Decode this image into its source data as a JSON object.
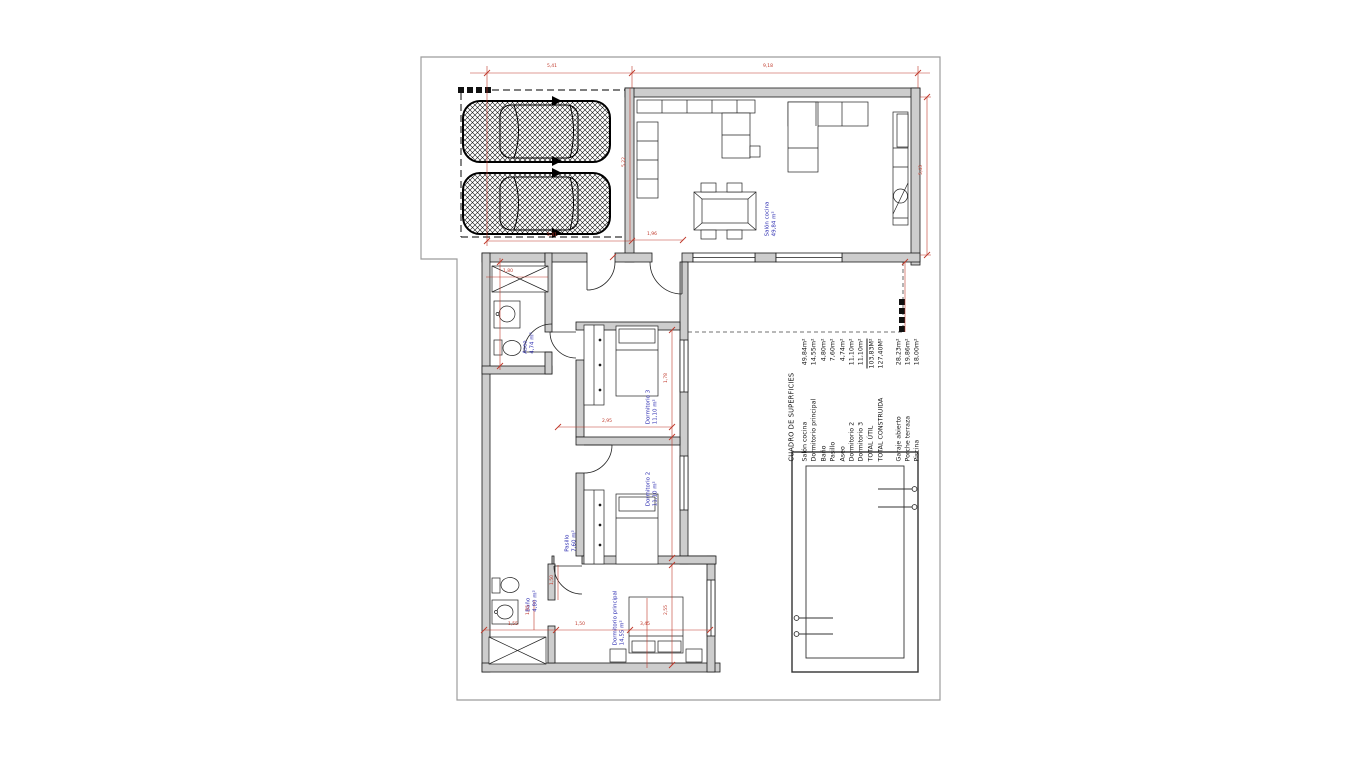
{
  "table": {
    "title": "CUADRO DE SUPERFICIES",
    "rows": [
      {
        "label": "Salón cocina",
        "value": "49,84m²"
      },
      {
        "label": "Dormitorio principal",
        "value": "14,55m²"
      },
      {
        "label": "Baño",
        "value": "4,80m²"
      },
      {
        "label": "Pasillo",
        "value": "7,60m²"
      },
      {
        "label": "Aseo",
        "value": "4,74m²"
      },
      {
        "label": "Dormitorio 2",
        "value": "11,10m²"
      },
      {
        "label": "Dormitorio 3",
        "value": "11,10m²"
      },
      {
        "label": "TOTAL ÚTIL",
        "value": "103,83M²"
      },
      {
        "label": "TOTAL CONSTRUIDA",
        "value": "127,40M²"
      }
    ],
    "extra": [
      {
        "label": "Garaje abierto",
        "value": "28,23m²"
      },
      {
        "label": "Porche terraza",
        "value": "19,86m²"
      },
      {
        "label": "Piscina",
        "value": "18,00m²"
      }
    ]
  },
  "rooms": [
    {
      "name": "Salón cocina",
      "area": "49,84 m²"
    },
    {
      "name": "Aseo",
      "area": "4,74 m²"
    },
    {
      "name": "Dormitorio 3",
      "area": "11,10 m²"
    },
    {
      "name": "Dormitorio 2",
      "area": "11,10 m²"
    },
    {
      "name": "Pasillo",
      "area": "7,60 m²"
    },
    {
      "name": "Baño",
      "area": "4,80 m²"
    },
    {
      "name": "Dormitorio principal",
      "area": "14,55 m²"
    }
  ],
  "dims": [
    "5,41",
    "9,18",
    "5,43",
    "5,22",
    "5,41",
    "1,96",
    "1,78",
    "2,95",
    "1,55",
    "1,50",
    "3,45",
    "2,55",
    "1,50",
    "1,55",
    "1,80"
  ],
  "colors": {
    "dimension_red": "#c0392b",
    "label_blue": "#2a2ab0",
    "wall_fill": "#cdcdcd",
    "wall_stroke": "#1a1a1a",
    "boundary_gray": "#9c9c9c"
  }
}
